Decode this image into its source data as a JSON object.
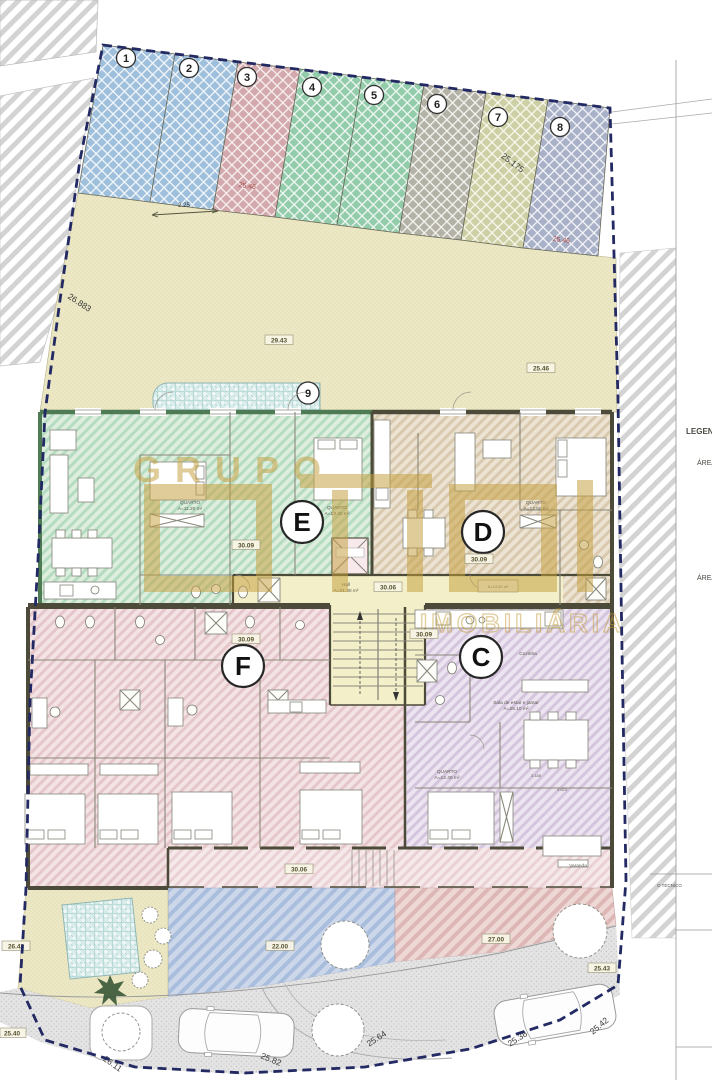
{
  "watermark": {
    "brand": "GRUPO",
    "brand2": "IMOBILIÁRIA"
  },
  "legend": {
    "title": "LEGENDA",
    "area1": "ÁREA",
    "area2": "ÁREA",
    "technician": "O TÉCNICO"
  },
  "parking": {
    "spaces": [
      "1",
      "2",
      "3",
      "4",
      "5",
      "6",
      "7",
      "8"
    ],
    "space9": "9",
    "dim_space3": "25.46",
    "dim_space7": "25.175",
    "dim_space8": "25.46",
    "scale_bar": "2.25"
  },
  "courtyard": {
    "dim_left": "29.43",
    "dim_right": "25.46"
  },
  "boundary": {
    "dim_left": "26.883",
    "dims_bottom": [
      "26.11",
      "25.82",
      "25.64",
      "25.38",
      "25.42"
    ]
  },
  "units": {
    "c": "C",
    "d": "D",
    "e": "E",
    "f": "F"
  },
  "levels": {
    "unit_e": "30.09",
    "unit_d": "30.09",
    "hall": "30.06",
    "unit_f": "30.09",
    "unit_c": "30.09",
    "balcony": "30.06"
  },
  "rooms": {
    "quarto": "QUARTO",
    "e_q1_area": "A=11.20 m²",
    "e_q2_area": "A=13.40 m²",
    "d_q_area": "A=12.50 m²",
    "d_area": "A=13.00 m²",
    "c_q_area": "A=12.40 m²",
    "hall": "Hall",
    "hall_area": "A=21.30 m²",
    "cozinha": "Cozinha",
    "sala": "Sala de estar e jantar",
    "sala_area": "A=25.10 m²",
    "varanda": "Varanda",
    "dim_a": "3.188",
    "dim_b": "4.823"
  },
  "outdoor": {
    "patio_blue": "22.00",
    "patio_pink": "27.00",
    "garden": "26.43",
    "road_left": "25.40",
    "road_right": "25.43"
  },
  "colors": {
    "boundary": "#232a63",
    "watermark": "#c59f3d",
    "dim_red": "#a84848"
  }
}
